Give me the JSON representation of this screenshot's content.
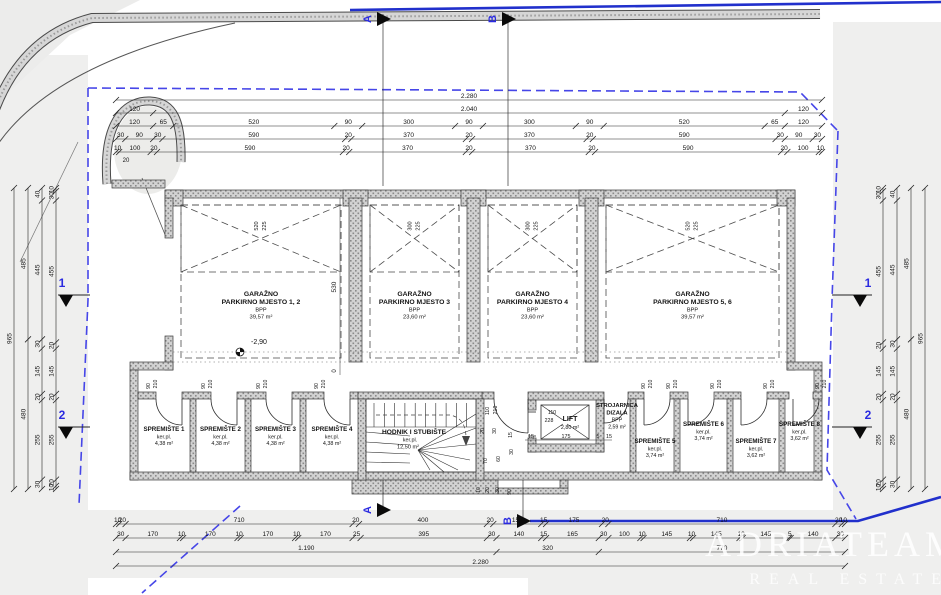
{
  "plan": {
    "garages": [
      {
        "name_line1": "GARAŽNO",
        "name_line2": "PARKIRNO MJESTO 1, 2",
        "area_label": "BPP",
        "area_value": "39,57 m²",
        "platform_w": "520",
        "platform_d": "225"
      },
      {
        "name_line1": "GARAŽNO",
        "name_line2": "PARKIRNO MJESTO 3",
        "area_label": "BPP",
        "area_value": "23,60 m²",
        "platform_w": "300",
        "platform_d": "225"
      },
      {
        "name_line1": "GARAŽNO",
        "name_line2": "PARKIRNO MJESTO 4",
        "area_label": "BPP",
        "area_value": "23,60 m²",
        "platform_w": "300",
        "platform_d": "225"
      },
      {
        "name_line1": "GARAŽNO",
        "name_line2": "PARKIRNO MJESTO 5, 6",
        "area_label": "BPP",
        "area_value": "39,57 m²",
        "platform_w": "520",
        "platform_d": "225"
      }
    ],
    "storages_left": [
      {
        "name": "SPREMIŠTE 1",
        "finish": "ker.pl.",
        "area": "4,38 m²"
      },
      {
        "name": "SPREMIŠTE 2",
        "finish": "ker.pl.",
        "area": "4,38 m²"
      },
      {
        "name": "SPREMIŠTE 3",
        "finish": "ker.pl.",
        "area": "4,38 m²"
      },
      {
        "name": "SPREMIŠTE 4",
        "finish": "ker.pl.",
        "area": "4,38 m²"
      }
    ],
    "storages_right": [
      {
        "name": "SPREMIŠTE 5",
        "finish": "ker.pl.",
        "area": "3,74 m²"
      },
      {
        "name": "SPREMIŠTE 6",
        "finish": "ker.pl.",
        "area": "3,74 m²"
      },
      {
        "name": "SPREMIŠTE 7",
        "finish": "ker.pl.",
        "area": "3,62 m²"
      },
      {
        "name": "SPREMIŠTE 8",
        "finish": "ker.pl.",
        "area": "3,62 m²"
      }
    ],
    "corridor": {
      "name": "HODNIK I STUBIŠTE",
      "finish": "ker.pl.",
      "area": "12,50 m²"
    },
    "lift": {
      "name": "LIFT",
      "area": "2,80 m²",
      "door_w": "110",
      "door_h": "228",
      "pit_dims": [
        "15",
        "175",
        "5",
        "15"
      ]
    },
    "machine_room": {
      "name_line1": "STROJARNICA",
      "name_line2": "DIZALA",
      "area_label": "BPP",
      "area_value": "2,59 m²"
    },
    "storage_door": {
      "w": "90",
      "h": "210"
    },
    "corridor_door": {
      "w": "110",
      "h": "210"
    },
    "elevation": "-2,90",
    "garage_depth": "530",
    "zero_mark": "0",
    "extra_mark": "20",
    "notch_dims": [
      "20",
      "30",
      "15",
      "70",
      "60",
      "30",
      "10",
      "20",
      "30",
      "90"
    ]
  },
  "dimensions": {
    "top": [
      [
        "2.280"
      ],
      [
        "120",
        "2.040",
        "120"
      ],
      [
        "120",
        "65",
        "520",
        "90",
        "300",
        "90",
        "300",
        "90",
        "520",
        "65",
        "120"
      ],
      [
        "30",
        "90",
        "30",
        "590",
        "20",
        "370",
        "20",
        "370",
        "20",
        "590",
        "30",
        "90",
        "30"
      ],
      [
        "10",
        "100",
        "20",
        "590",
        "20",
        "370",
        "20",
        "370",
        "20",
        "590",
        "20",
        "100",
        "10"
      ]
    ],
    "bottom": [
      [
        "10",
        "20",
        "710",
        "20",
        "400",
        "20",
        "150",
        "15",
        "175",
        "20",
        "710",
        "20",
        "10"
      ],
      [
        "30",
        "170",
        "10",
        "170",
        "10",
        "170",
        "10",
        "170",
        "25",
        "395",
        "30",
        "140",
        "15",
        "165",
        "30",
        "100",
        "10",
        "145",
        "10",
        "145",
        "10",
        "145",
        "5",
        "140",
        "30"
      ],
      [
        "1.190",
        "320",
        "770"
      ],
      [
        "2.280"
      ]
    ],
    "left": [
      [
        "965"
      ],
      [
        "485",
        "480"
      ],
      [
        "40",
        "445",
        "30",
        "145",
        "20",
        "255",
        "30"
      ],
      [
        "10",
        "30",
        "455",
        "20",
        "145",
        "20",
        "255",
        "20",
        "10"
      ]
    ],
    "right": [
      [
        "965"
      ],
      [
        "485",
        "480"
      ],
      [
        "40",
        "445",
        "30",
        "145",
        "20",
        "255",
        "30"
      ],
      [
        "10",
        "30",
        "455",
        "20",
        "145",
        "20",
        "255",
        "20",
        "10"
      ]
    ]
  },
  "sections": {
    "s1": "1",
    "s2": "2",
    "sA": "A",
    "sB": "B"
  },
  "watermark": {
    "line1": "ADRIATEAM",
    "line2": "REAL ESTATE"
  },
  "colors": {
    "boundary": "#4646e8",
    "road_line": "#2130cc",
    "wall_bg": "#d2d2d2",
    "wall_dot": "#8a8a8a",
    "line": "#2b2b2b",
    "marker_blue": "#2a2ae0"
  }
}
